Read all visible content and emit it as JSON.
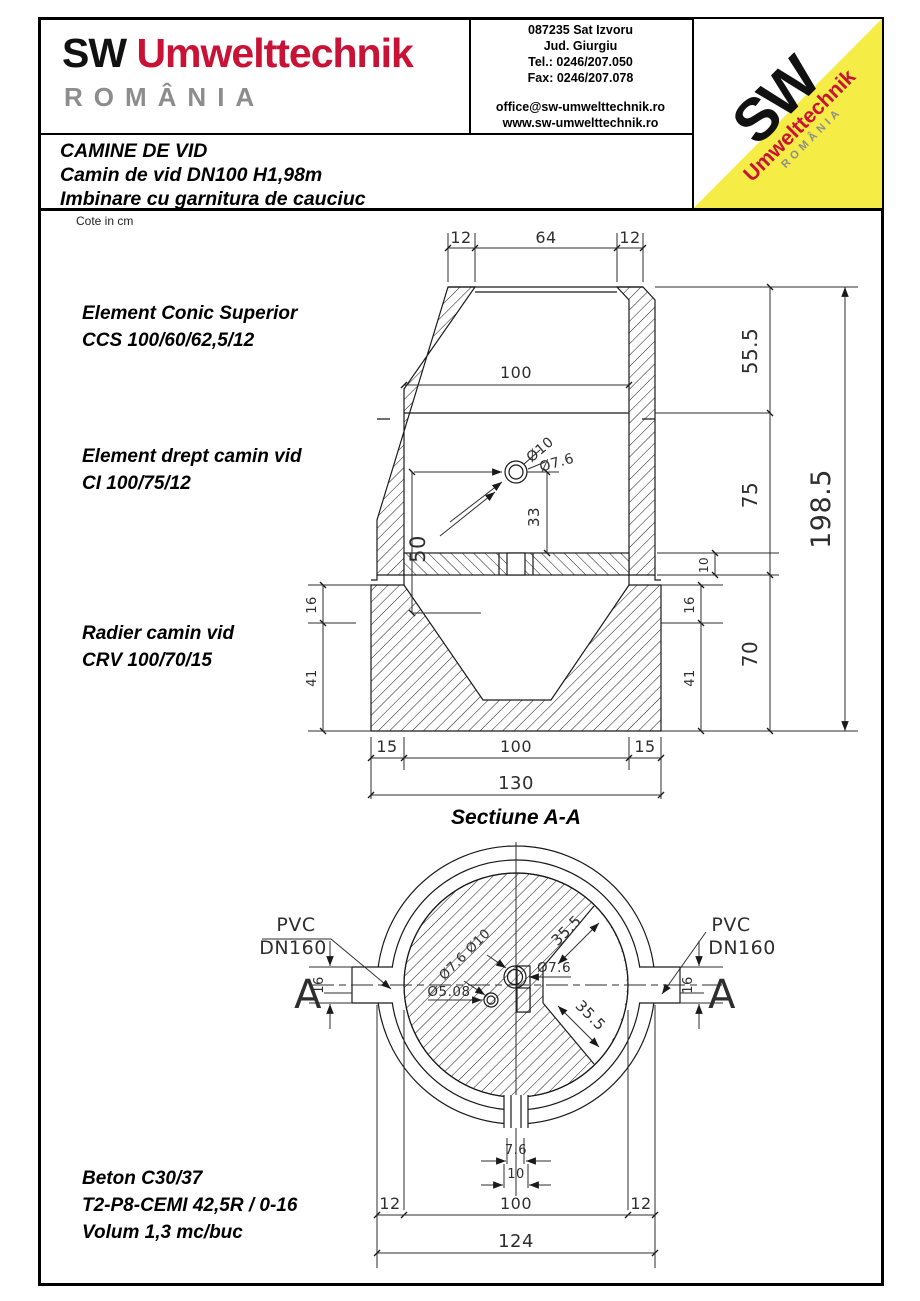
{
  "header": {
    "logo": {
      "sw": "SW",
      "brand": "Umwelttechnik",
      "country": "ROMÂNIA"
    },
    "contact": {
      "address_line1": "087235 Sat Izvoru",
      "address_line2": "Jud. Giurgiu",
      "tel": "Tel.: 0246/207.050",
      "fax": "Fax: 0246/207.078",
      "email": "office@sw-umwelttechnik.ro",
      "website": "www.sw-umwelttechnik.ro"
    },
    "corner_logo": {
      "sw": "SW",
      "brand": "Umwelttechnik",
      "country": "ROMÂNIA"
    },
    "title_block": {
      "line1": "CAMINE DE VID",
      "line2": "Camin de vid DN100 H1,98m",
      "line3": "Imbinare cu garnitura de cauciuc"
    }
  },
  "drawing": {
    "note": "Cote in cm",
    "section_caption": "Sectiune A-A",
    "component_labels": {
      "ccs_line1": "Element Conic Superior",
      "ccs_line2": "CCS 100/60/62,5/12",
      "ci_line1": "Element drept camin vid",
      "ci_line2": "CI 100/75/12",
      "crv_line1": "Radier camin vid",
      "crv_line2": "CRV 100/70/15"
    },
    "material_notes": {
      "line1": "Beton C30/37",
      "line2": "T2-P8-CEMI 42,5R / 0-16",
      "line3": "Volum 1,3 mc/buc"
    },
    "section_dims": {
      "top_left": "12",
      "top_center": "64",
      "top_right": "12",
      "inner_width": "100",
      "pipe_outer": "Ø10",
      "pipe_inner": "Ø7.6",
      "offset_50": "50",
      "offset_33": "33",
      "cone_height": "55.5",
      "shaft_height": "75",
      "base_height": "70",
      "shelf_thickness": "10",
      "rim_16": "16",
      "base_41": "41",
      "total_height": "198.5",
      "bottom_left": "15",
      "bottom_center": "100",
      "bottom_right": "15",
      "bottom_total": "130"
    },
    "plan_dims": {
      "pipe_label_line1": "PVC",
      "pipe_label_line2": "DN160",
      "section_marker": "A",
      "stub_16": "16",
      "diag_35": "35.5",
      "d10": "Ø10",
      "d76": "Ø7.6",
      "d508": "Ø5.08",
      "stub_76": "7.6",
      "stub_10": "10",
      "bottom_left": "12",
      "bottom_center": "100",
      "bottom_right": "12",
      "bottom_total": "124"
    },
    "colors": {
      "brand_red": "#c81236",
      "brand_gray": "#8d8d8d",
      "logo_yellow": "#f5ec45",
      "line": "#1a1a1a"
    }
  }
}
